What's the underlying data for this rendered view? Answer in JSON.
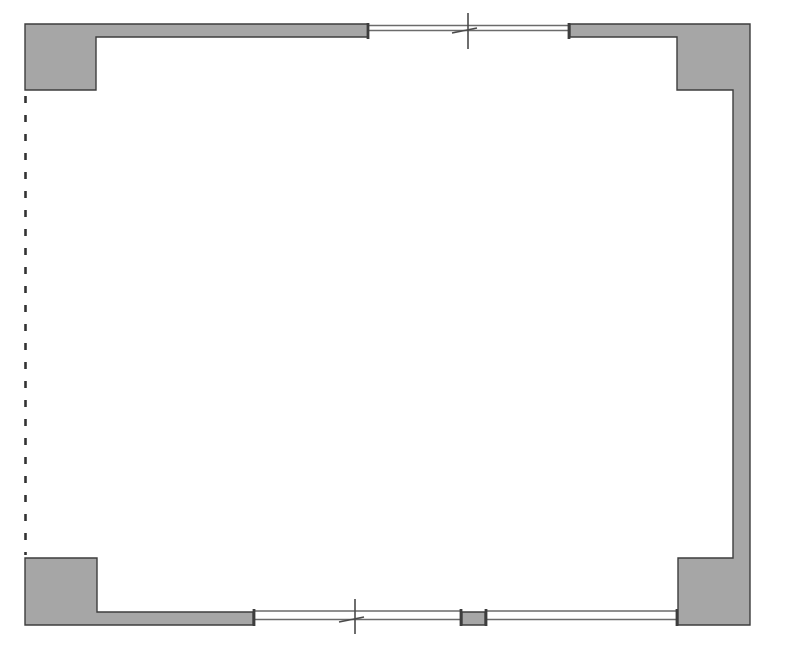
{
  "page": {
    "title": "floor-plan-drawing"
  },
  "floorplan": {
    "canvas": {
      "width": 787,
      "height": 653
    },
    "colors": {
      "background": "#ffffff",
      "wall_fill": "#a6a6a6",
      "wall_stroke": "#3d3d3d",
      "window_line": "#6b6b6b",
      "jamb": "#3d3d3d",
      "center_mark": "#4a4a4a",
      "dashed_open_side": "#333333"
    },
    "walls": [
      {
        "name": "wall-top-left-with-corner-pier",
        "points": "25,24 368,24 368,37 96,37 96,90 25,90"
      },
      {
        "name": "wall-right-assembly-with-corner-piers",
        "points": "570,24 750,24 750,625 678,625 678,558 733,558 733,90 677,90 677,37 570,37"
      },
      {
        "name": "wall-bottom-left-with-corner-pier",
        "points": "25,558 97,558 97,612 253,612 253,625 25,625"
      },
      {
        "name": "window-mullion-pier",
        "points": "462,612 485,612 485,625 462,625"
      }
    ],
    "windows": [
      {
        "name": "window-top",
        "lines": [
          [
            368,
            25.5,
            570,
            25.5
          ],
          [
            368,
            30.5,
            570,
            30.5
          ]
        ]
      },
      {
        "name": "window-bottom-left",
        "lines": [
          [
            253,
            611,
            462,
            611
          ],
          [
            253,
            619.5,
            462,
            619.5
          ]
        ]
      },
      {
        "name": "window-bottom-right",
        "lines": [
          [
            485,
            611,
            678,
            611
          ],
          [
            485,
            619.5,
            678,
            619.5
          ]
        ]
      }
    ],
    "jambs": [
      {
        "name": "jamb-top-window-left",
        "line": [
          368,
          23,
          368,
          39
        ]
      },
      {
        "name": "jamb-top-window-right",
        "line": [
          569,
          23,
          569,
          39
        ]
      },
      {
        "name": "jamb-bottom-left-window-left",
        "line": [
          254,
          609,
          254,
          626
        ]
      },
      {
        "name": "jamb-bottom-left-window-right",
        "line": [
          461,
          609,
          461,
          626
        ]
      },
      {
        "name": "jamb-bottom-right-window-left",
        "line": [
          486,
          609,
          486,
          626
        ]
      },
      {
        "name": "jamb-bottom-right-window-right",
        "line": [
          677,
          609,
          677,
          626
        ]
      }
    ],
    "center_marks": [
      {
        "name": "center-mark-top-window",
        "vline": [
          468,
          13,
          468,
          49
        ],
        "tick": [
          452,
          33,
          477,
          28
        ]
      },
      {
        "name": "center-mark-bottom-window",
        "vline": [
          355,
          599,
          355,
          634
        ],
        "tick": [
          339,
          622,
          364,
          617
        ]
      }
    ],
    "open_side": {
      "name": "dashed-open-side-line",
      "line": [
        25.5,
        96,
        25.5,
        555
      ],
      "dash": "7 12",
      "width": 2.6
    }
  }
}
